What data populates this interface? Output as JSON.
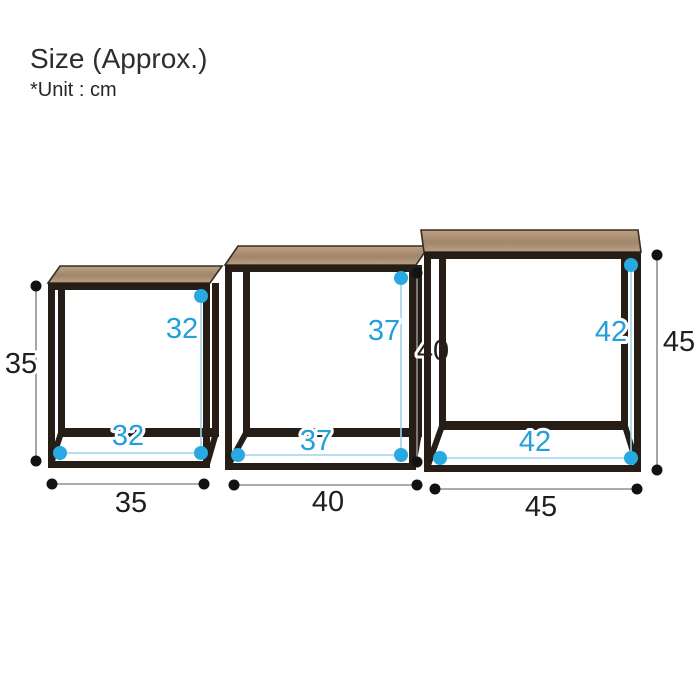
{
  "header": {
    "title": "Size (Approx.)",
    "unit_note": "*Unit : cm"
  },
  "colors": {
    "background": "#ffffff",
    "frame": "#251d16",
    "frame_edge": "#382d22",
    "wood_light": "#bba183",
    "wood_dark": "#a2856a",
    "dimension_black_text": "#1f1f1f",
    "dimension_blue_text": "#239fdb",
    "measure_line_gray": "#8f8f8f",
    "measure_line_blue": "#9ed2ec",
    "dot_black": "#121212",
    "dot_blue": "#29a9e1"
  },
  "diagram": {
    "unit": "cm",
    "tables": [
      {
        "name": "small-table",
        "outer_width": "35",
        "outer_height": "35",
        "inner_width": "32",
        "inner_height": "32"
      },
      {
        "name": "medium-table",
        "outer_width": "40",
        "outer_height": "40",
        "inner_width": "37",
        "inner_height": "37"
      },
      {
        "name": "large-table",
        "outer_width": "45",
        "outer_height": "45",
        "inner_width": "42",
        "inner_height": "42"
      }
    ]
  }
}
